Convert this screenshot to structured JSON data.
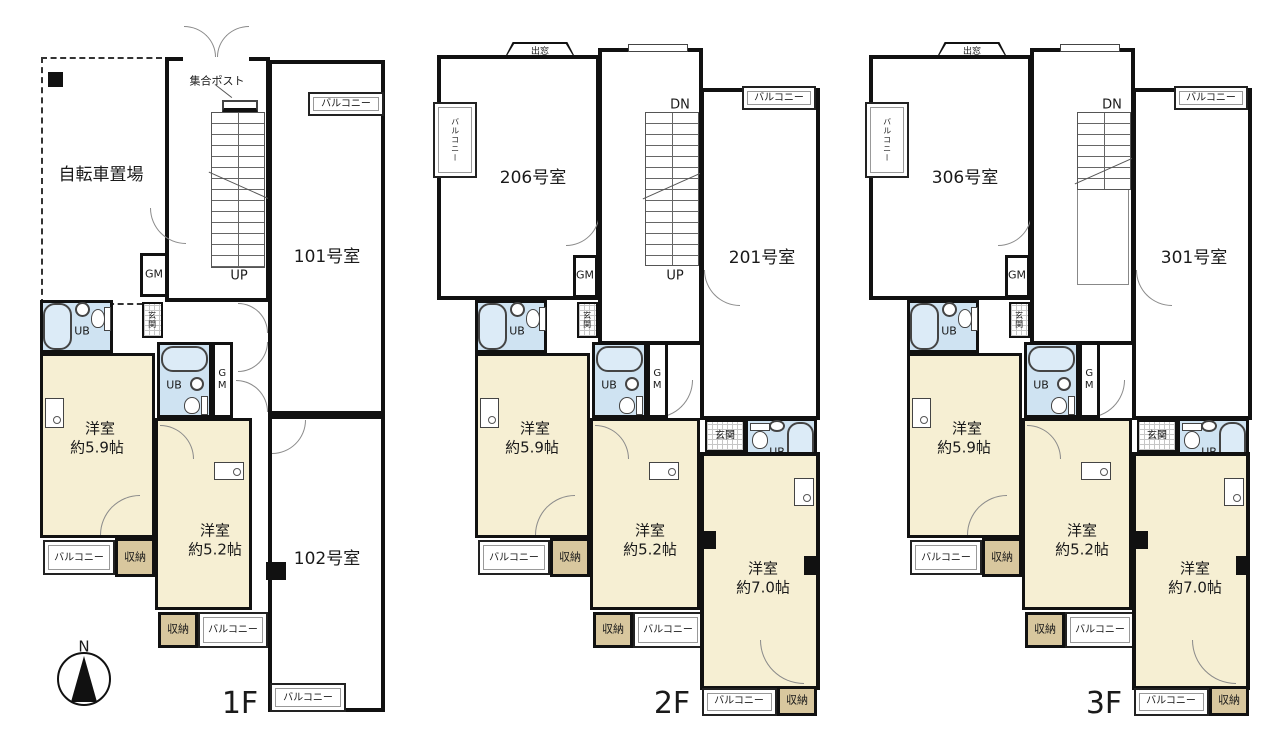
{
  "colors": {
    "wall": "#111111",
    "room_fill": "#f6efd3",
    "ub_fill": "#cfe3f2",
    "storage_fill": "#d8c79e",
    "background": "#ffffff"
  },
  "compass": {
    "north_label": "N"
  },
  "floors": {
    "f1": {
      "floor_label": "1F",
      "bicycle_area": "自転車置場",
      "mail_post": "集合ポスト",
      "unit_top": "101号室",
      "unit_bottom": "102号室",
      "stairs_up": "UP",
      "gm": "GM",
      "ub": "UB",
      "genkan": "玄関",
      "balcony": "バルコニー",
      "storage": "収納",
      "room_name": "洋室",
      "room59_size": "約5.9帖",
      "room52_size": "約5.2帖"
    },
    "f2": {
      "floor_label": "2F",
      "bay_window": "出窓",
      "unit_left": "206号室",
      "unit_right": "201号室",
      "stairs_dn": "DN",
      "stairs_up": "UP",
      "gm": "GM",
      "ub": "UB",
      "genkan": "玄関",
      "balcony": "バルコニー",
      "storage": "収納",
      "room_name": "洋室",
      "room59_size": "約5.9帖",
      "room52_size": "約5.2帖",
      "room70_size": "約7.0帖"
    },
    "f3": {
      "floor_label": "3F",
      "bay_window": "出窓",
      "unit_left": "306号室",
      "unit_right": "301号室",
      "stairs_dn": "DN",
      "gm": "GM",
      "ub": "UB",
      "genkan": "玄関",
      "balcony": "バルコニー",
      "storage": "収納",
      "room_name": "洋室",
      "room59_size": "約5.9帖",
      "room52_size": "約5.2帖",
      "room70_size": "約7.0帖"
    }
  }
}
